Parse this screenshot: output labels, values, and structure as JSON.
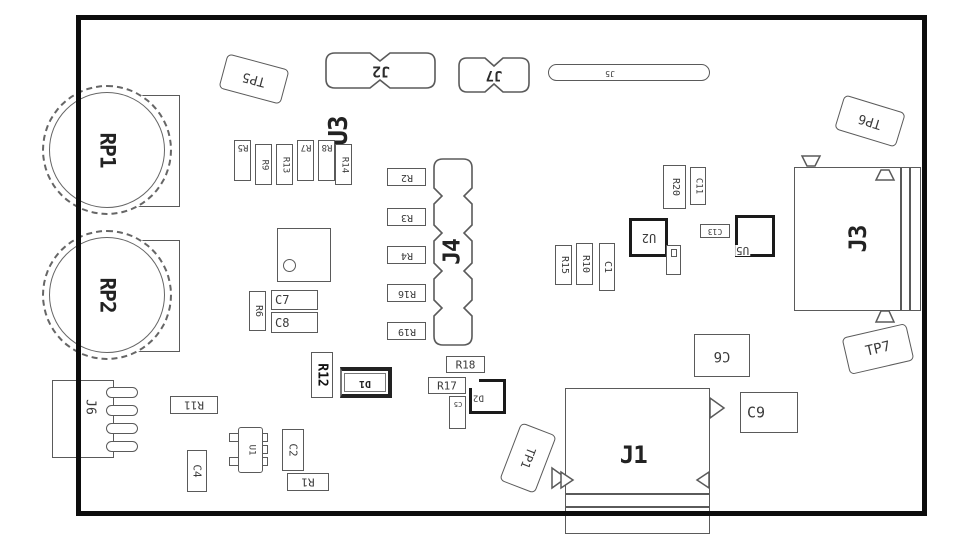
{
  "diagram_type": "pcb-silkscreen-assembly-drawing",
  "colors": {
    "background": "#ffffff",
    "board_outline": "#0d0d0d",
    "component_outline": "#5a5a5a",
    "component_outline_bold": "#1a1a1a",
    "text": "#3a3a3a"
  },
  "components": {
    "potentiometers": {
      "rp1": "RP1",
      "rp2": "RP2"
    },
    "connectors": {
      "j1": "J1",
      "j2": "J2",
      "j3": "J3",
      "j4": "J4",
      "j5": "J5",
      "j6": "J6",
      "j7": "J7"
    },
    "test_points": {
      "tp1": "TP1",
      "tp5": "TP5",
      "tp6": "TP6",
      "tp7": "TP7"
    },
    "ics": {
      "u1": "U1",
      "u2": "U2",
      "u3": "U3",
      "u5": "U5"
    },
    "diodes": {
      "d1": "D1",
      "d2": "D2"
    },
    "resistors": {
      "r1": "R1",
      "r2": "R2",
      "r3": "R3",
      "r4": "R4",
      "r5": "R5",
      "r6": "R6",
      "r7": "R7",
      "r8": "R8",
      "r9": "R9",
      "r10": "R10",
      "r11": "R11",
      "r12": "R12",
      "r13": "R13",
      "r14": "R14",
      "r15": "R15",
      "r16": "R16",
      "r17": "R17",
      "r18": "R18",
      "r19": "R19",
      "r20": "R20"
    },
    "capacitors": {
      "c1": "C1",
      "c2": "C2",
      "c4": "C4",
      "c5": "C5",
      "c6": "C6",
      "c7": "C7",
      "c8": "C8",
      "c9": "C9",
      "c11": "C11",
      "c13": "C13"
    }
  }
}
